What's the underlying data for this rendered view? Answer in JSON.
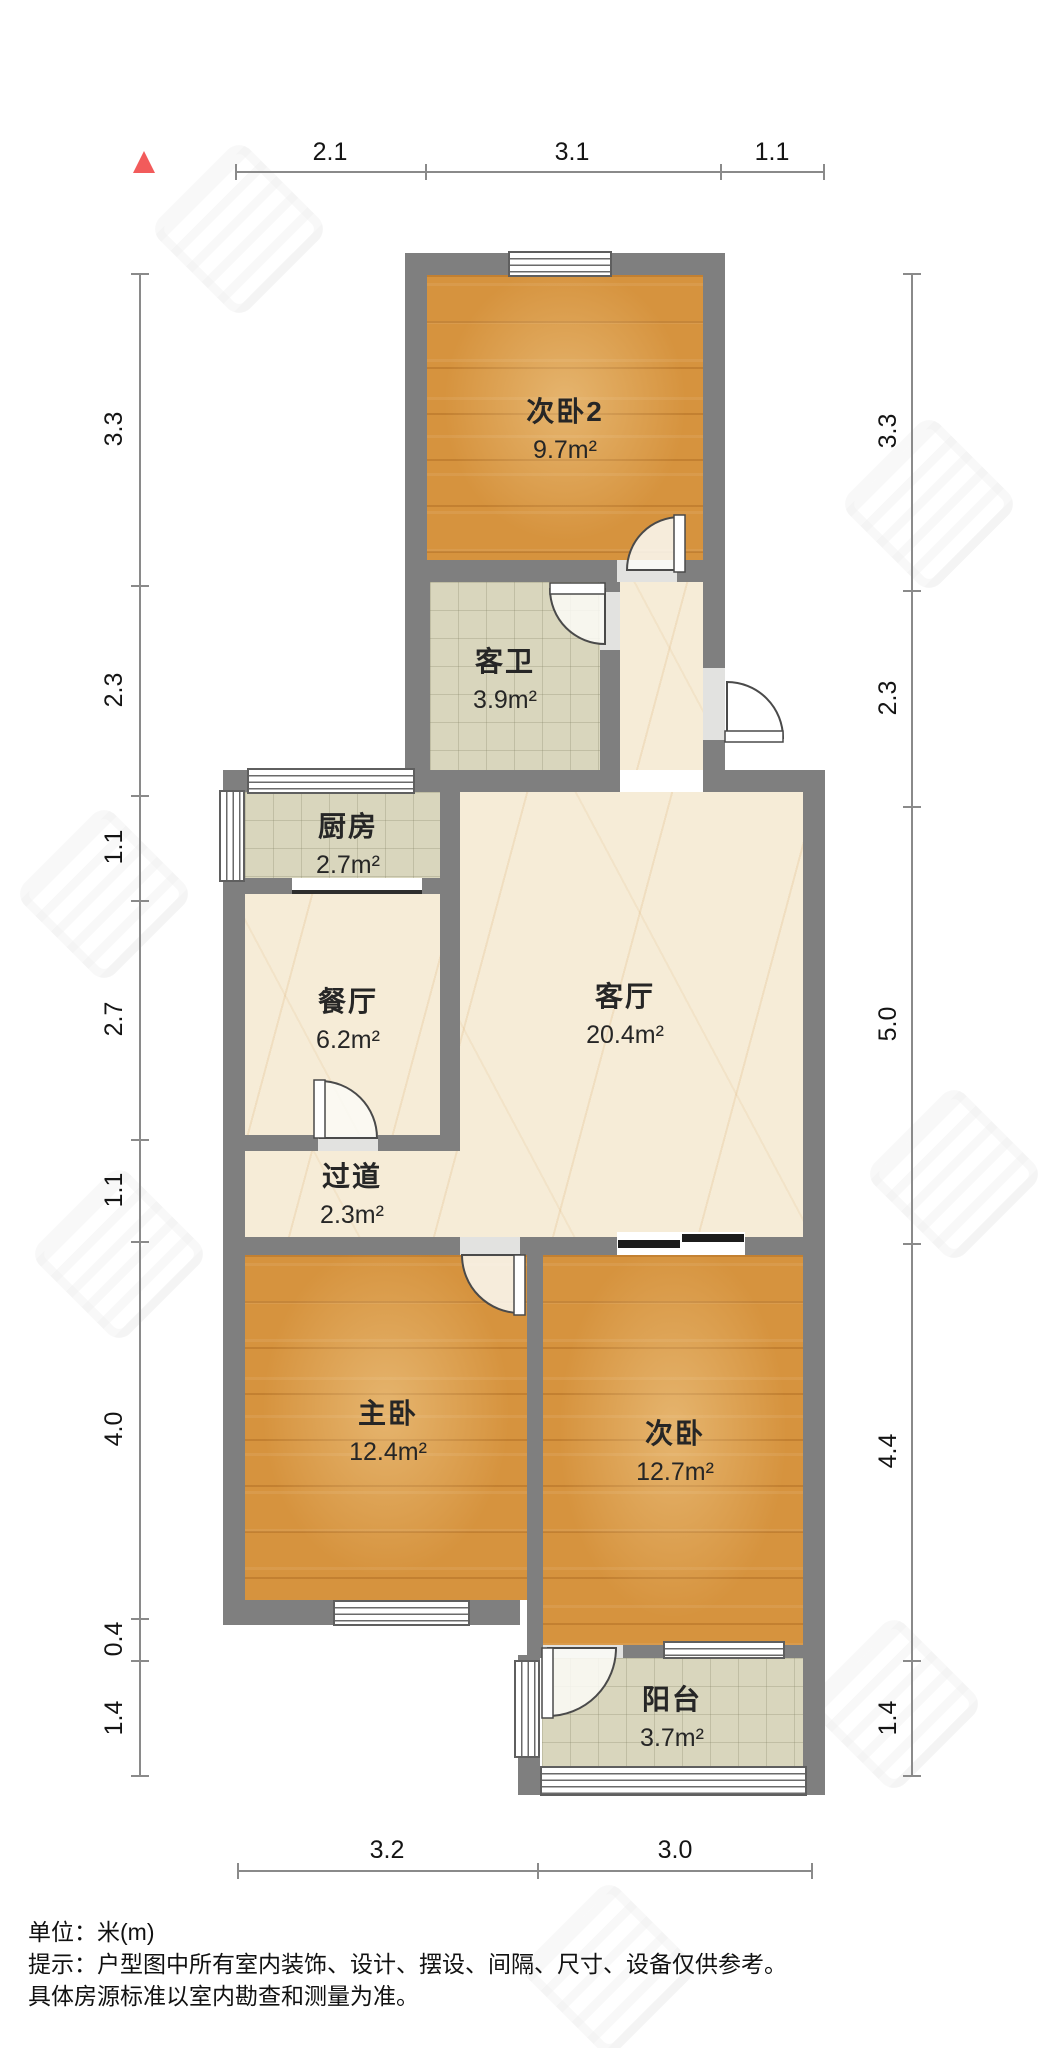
{
  "compass": {
    "symbol": "north-triangle",
    "color": "#f25b5b"
  },
  "rooms": {
    "bedroom2": {
      "name": "次卧2",
      "area": "9.7m²",
      "floor": "wood"
    },
    "bathroom": {
      "name": "客卫",
      "area": "3.9m²",
      "floor": "tile"
    },
    "kitchen": {
      "name": "厨房",
      "area": "2.7m²",
      "floor": "tile"
    },
    "dining": {
      "name": "餐厅",
      "area": "6.2m²",
      "floor": "marble"
    },
    "living": {
      "name": "客厅",
      "area": "20.4m²",
      "floor": "marble"
    },
    "hallway": {
      "name": "过道",
      "area": "2.3m²",
      "floor": "marble"
    },
    "master": {
      "name": "主卧",
      "area": "12.4m²",
      "floor": "wood"
    },
    "bedroom": {
      "name": "次卧",
      "area": "12.7m²",
      "floor": "wood"
    },
    "balcony": {
      "name": "阳台",
      "area": "3.7m²",
      "floor": "tile"
    }
  },
  "dimensions": {
    "top": [
      "2.1",
      "3.1",
      "1.1"
    ],
    "bottom": [
      "3.2",
      "3.0"
    ],
    "left": [
      "3.3",
      "2.3",
      "1.1",
      "2.7",
      "1.1",
      "4.0",
      "0.4",
      "1.4"
    ],
    "right": [
      "3.3",
      "2.3",
      "5.0",
      "4.4",
      "1.4"
    ]
  },
  "footer": {
    "unit_note": "单位：米(m)",
    "disclaimer_line1": "提示：户型图中所有室内装饰、设计、摆设、间隔、尺寸、设备仅供参考。",
    "disclaimer_line2": "具体房源标准以室内勘查和测量为准。"
  },
  "palette": {
    "wall": "#7f7f7f",
    "wood_floor": "#d6933e",
    "tile_floor": "#d9d6bd",
    "marble_floor": "#f6ecd7",
    "dimension_line": "#8a8a8a",
    "text": "#262626"
  }
}
